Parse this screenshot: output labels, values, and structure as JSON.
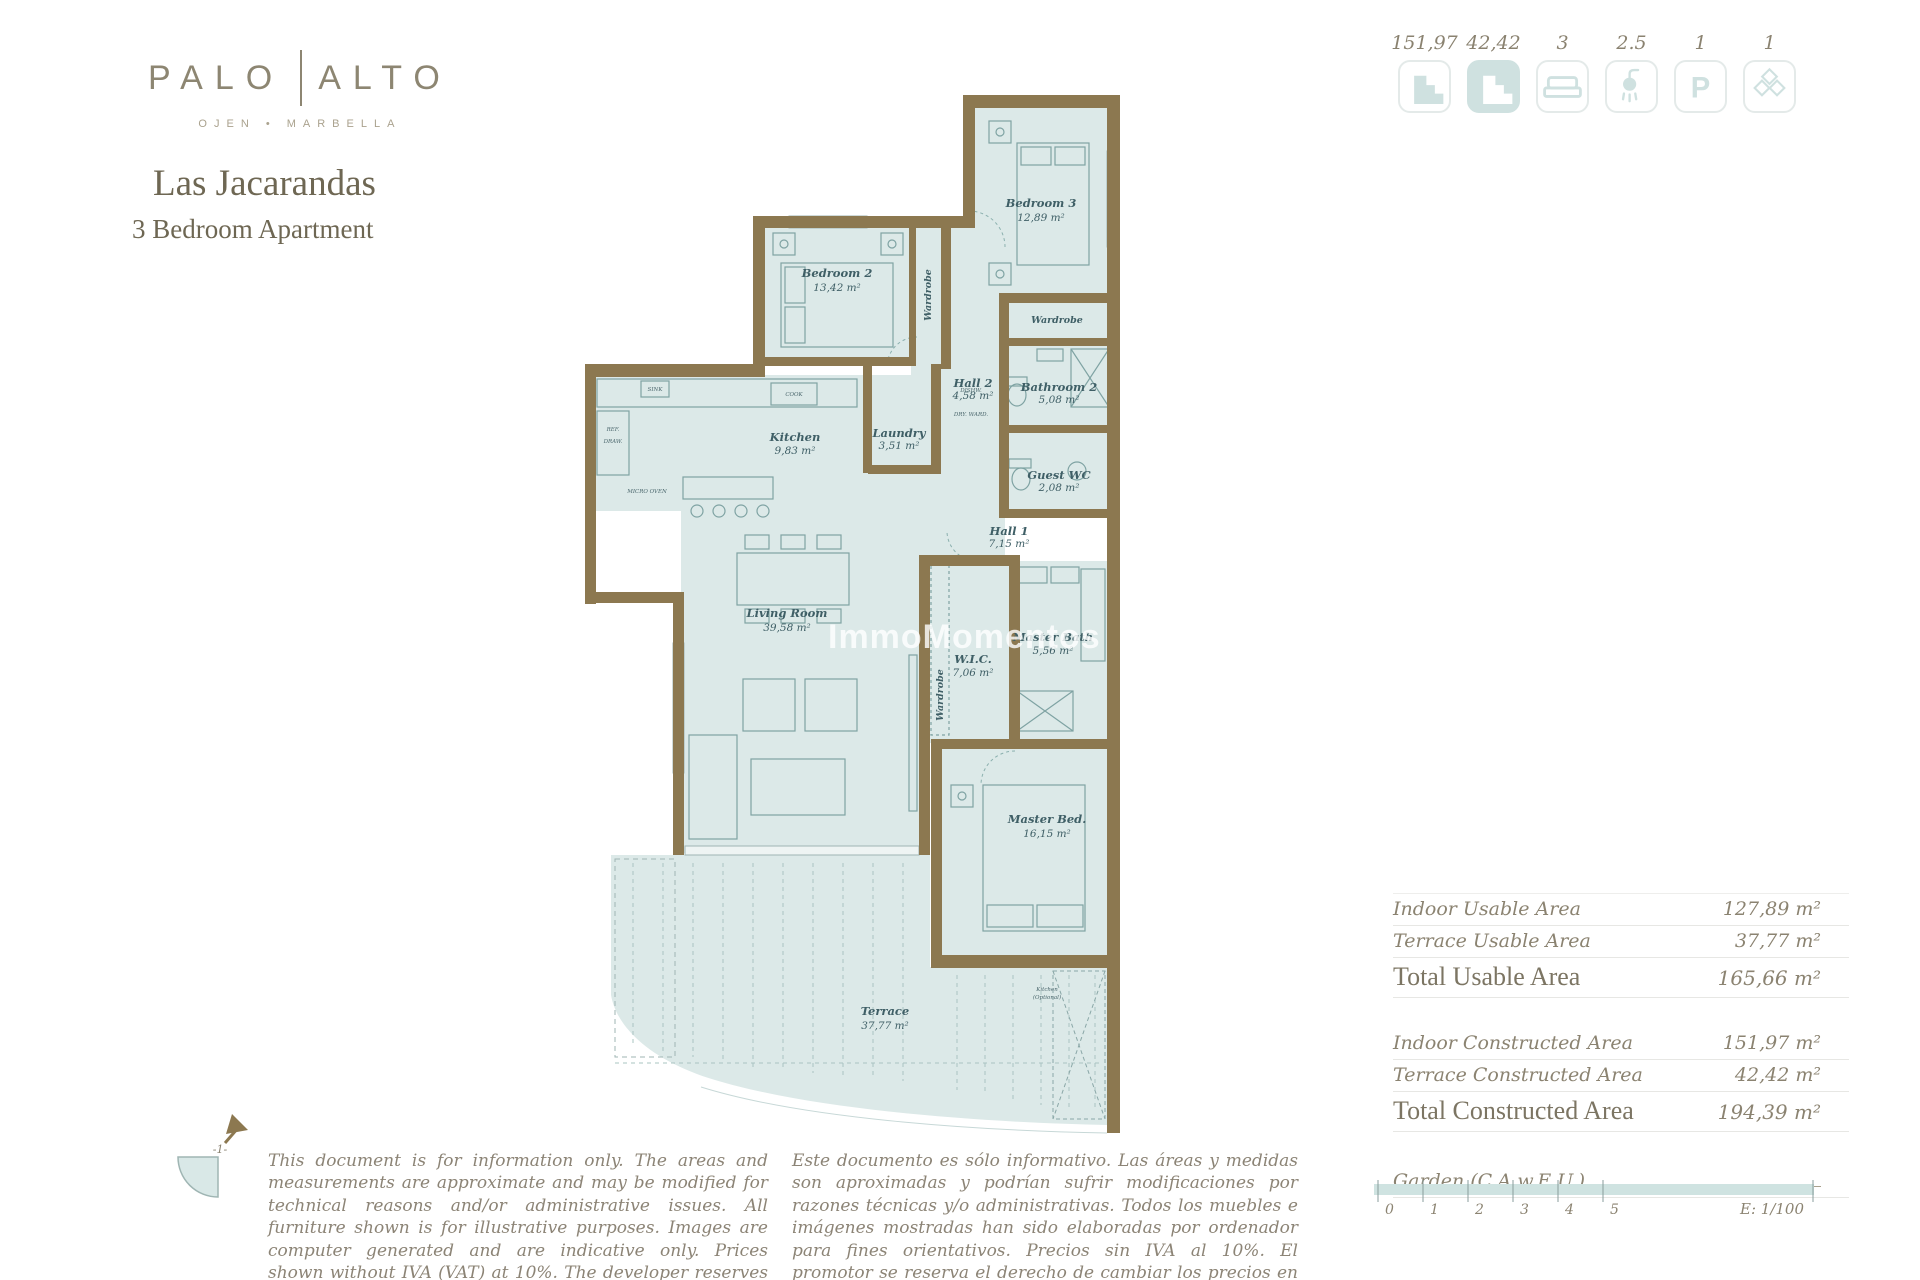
{
  "brand": {
    "word_left": "PALO",
    "word_right": "ALTO",
    "subtitle": "OJEN • MARBELLA"
  },
  "header": {
    "title": "Las Jacarandas",
    "subtitle": "3  Bedroom Apartment"
  },
  "accent_colors": {
    "wall_brown": "#8c7850",
    "room_teal": "#dce9e8",
    "icon_teal": "#cfe1e0",
    "text_brown": "#8b8371"
  },
  "stats": [
    {
      "icon": "indoor-plan-icon",
      "value": "151,97"
    },
    {
      "icon": "terrace-plan-icon",
      "value": "42,42"
    },
    {
      "icon": "bed-icon",
      "value": "3"
    },
    {
      "icon": "shower-icon",
      "value": "2.5"
    },
    {
      "icon": "parking-icon",
      "value": "1"
    },
    {
      "icon": "storage-icon",
      "value": "1"
    }
  ],
  "plan": {
    "rooms": [
      {
        "name": "Bedroom 3",
        "area": "12,89 m²"
      },
      {
        "name": "Bedroom 2",
        "area": "13,42 m²"
      },
      {
        "name": "Hall 2",
        "area": "4,58 m²"
      },
      {
        "name": "Bathroom 2",
        "area": "5,08 m²"
      },
      {
        "name": "Kitchen",
        "area": "9,83 m²"
      },
      {
        "name": "Laundry",
        "area": "3,51 m²"
      },
      {
        "name": "Guest WC",
        "area": "2,08 m²"
      },
      {
        "name": "Hall 1",
        "area": "7,15 m²"
      },
      {
        "name": "Living Room",
        "area": "39,58 m²"
      },
      {
        "name": "W.I.C.",
        "area": "7,06 m²"
      },
      {
        "name": "Master Bath",
        "area": "5,56 m²"
      },
      {
        "name": "Master Bed.",
        "area": "16,15 m²"
      },
      {
        "name": "Terrace",
        "area": "37,77 m²"
      }
    ],
    "wardrobe_label": "Wardrobe",
    "optional_kitchen": {
      "line1": "Kitchen",
      "line2": "(Optional)"
    },
    "appliances": {
      "cook": "COOK",
      "draw": "DRAW.",
      "dishw": "DISHW.",
      "dry": "DRY. WARD.",
      "sink": "SINK",
      "micro": "MICRO OVEN",
      "ref": "REF."
    },
    "watermark": "ImmoMomentos"
  },
  "areas_table": {
    "rows": [
      {
        "label": "Indoor Usable Area",
        "value": "127,89 m²",
        "total": false
      },
      {
        "label": "Terrace Usable Area",
        "value": "37,77 m²",
        "total": false
      },
      {
        "label": "Total Usable Area",
        "value": "165,66 m²",
        "total": true
      },
      {
        "label": "Indoor Constructed Area",
        "value": "151,97 m²",
        "total": false
      },
      {
        "label": "Terrace Constructed Area",
        "value": "42,42 m²",
        "total": false
      },
      {
        "label": "Total Constructed Area",
        "value": "194,39 m²",
        "total": true
      }
    ],
    "garden_label": "Garden (C.A.w.E.U.)"
  },
  "scale_bar": {
    "ticks": [
      "0",
      "1",
      "2",
      "3",
      "4",
      "5"
    ],
    "label": "E: 1/100"
  },
  "compass": {
    "label": "-1-"
  },
  "disclaimer_en": "This document is for information only. The areas and measurements are approximate and may be modified for technical reasons and/or administrative issues. All furniture shown is for illustrative purposes. Images are computer generated and are indicative only. Prices shown without IVA (VAT) at 10%. The developer reserves the right to change the prices at any time.",
  "disclaimer_es": "Este documento es sólo informativo. Las áreas y medidas son aproximadas y podrían sufrir modificaciones por razones técnicas y/o administrativas. Todos los muebles e imágenes mostradas han sido elaboradas por ordenador para fines orientativos. Precios sin IVA al 10%. El promotor se reserva el derecho de cambiar los precios en cualquier momento."
}
